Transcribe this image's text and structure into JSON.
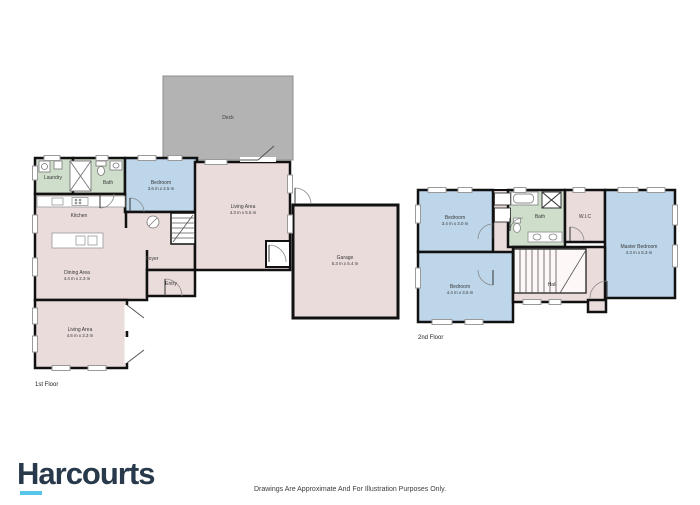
{
  "branding": {
    "logo_text": "Harcourts",
    "logo_color": "#27394a",
    "logo_underline_color": "#55c6e8"
  },
  "footer": {
    "disclaimer": "Drawings Are Approximate And For Illustration Purposes Only."
  },
  "floors": {
    "first": {
      "label": "1st Floor",
      "rooms": {
        "deck": {
          "name": "Deck"
        },
        "laundry": {
          "name": "Laundry"
        },
        "bath": {
          "name": "Bath"
        },
        "bedroom": {
          "name": "Bedroom",
          "dims": "3.6 m x 2.5 m"
        },
        "kitchen": {
          "name": "Kitchen"
        },
        "dining": {
          "name": "Dining Area",
          "dims": "4.4 m x 2.3 m"
        },
        "foyer": {
          "name": "Foyer"
        },
        "entry": {
          "name": "Entry"
        },
        "living_upper": {
          "name": "Living Area",
          "dims": "4.3 m x 5.5 m"
        },
        "living_lower": {
          "name": "Living Area",
          "dims": "4.6 m x 3.3 m"
        },
        "garage": {
          "name": "Garage",
          "dims": "5.3 m x 5.4 m"
        }
      }
    },
    "second": {
      "label": "2nd Floor",
      "rooms": {
        "bedroom_a": {
          "name": "Bedroom",
          "dims": "3.4 m x 3.0 m"
        },
        "bedroom_b": {
          "name": "Bedroom",
          "dims": "4.4 m x 3.5 m"
        },
        "bath": {
          "name": "Bath"
        },
        "wic": {
          "name": "W.I.C"
        },
        "master": {
          "name": "Master Bedroom",
          "dims": "4.3 m x 5.3 m"
        },
        "hall": {
          "name": "Hall"
        }
      }
    }
  },
  "colors": {
    "floor_fill": "#e9dcda",
    "bedroom_fill": "#bdd6ea",
    "bath_fill": "#cfdecb",
    "deck_fill": "#b3b3b3",
    "wall": "#111111"
  }
}
